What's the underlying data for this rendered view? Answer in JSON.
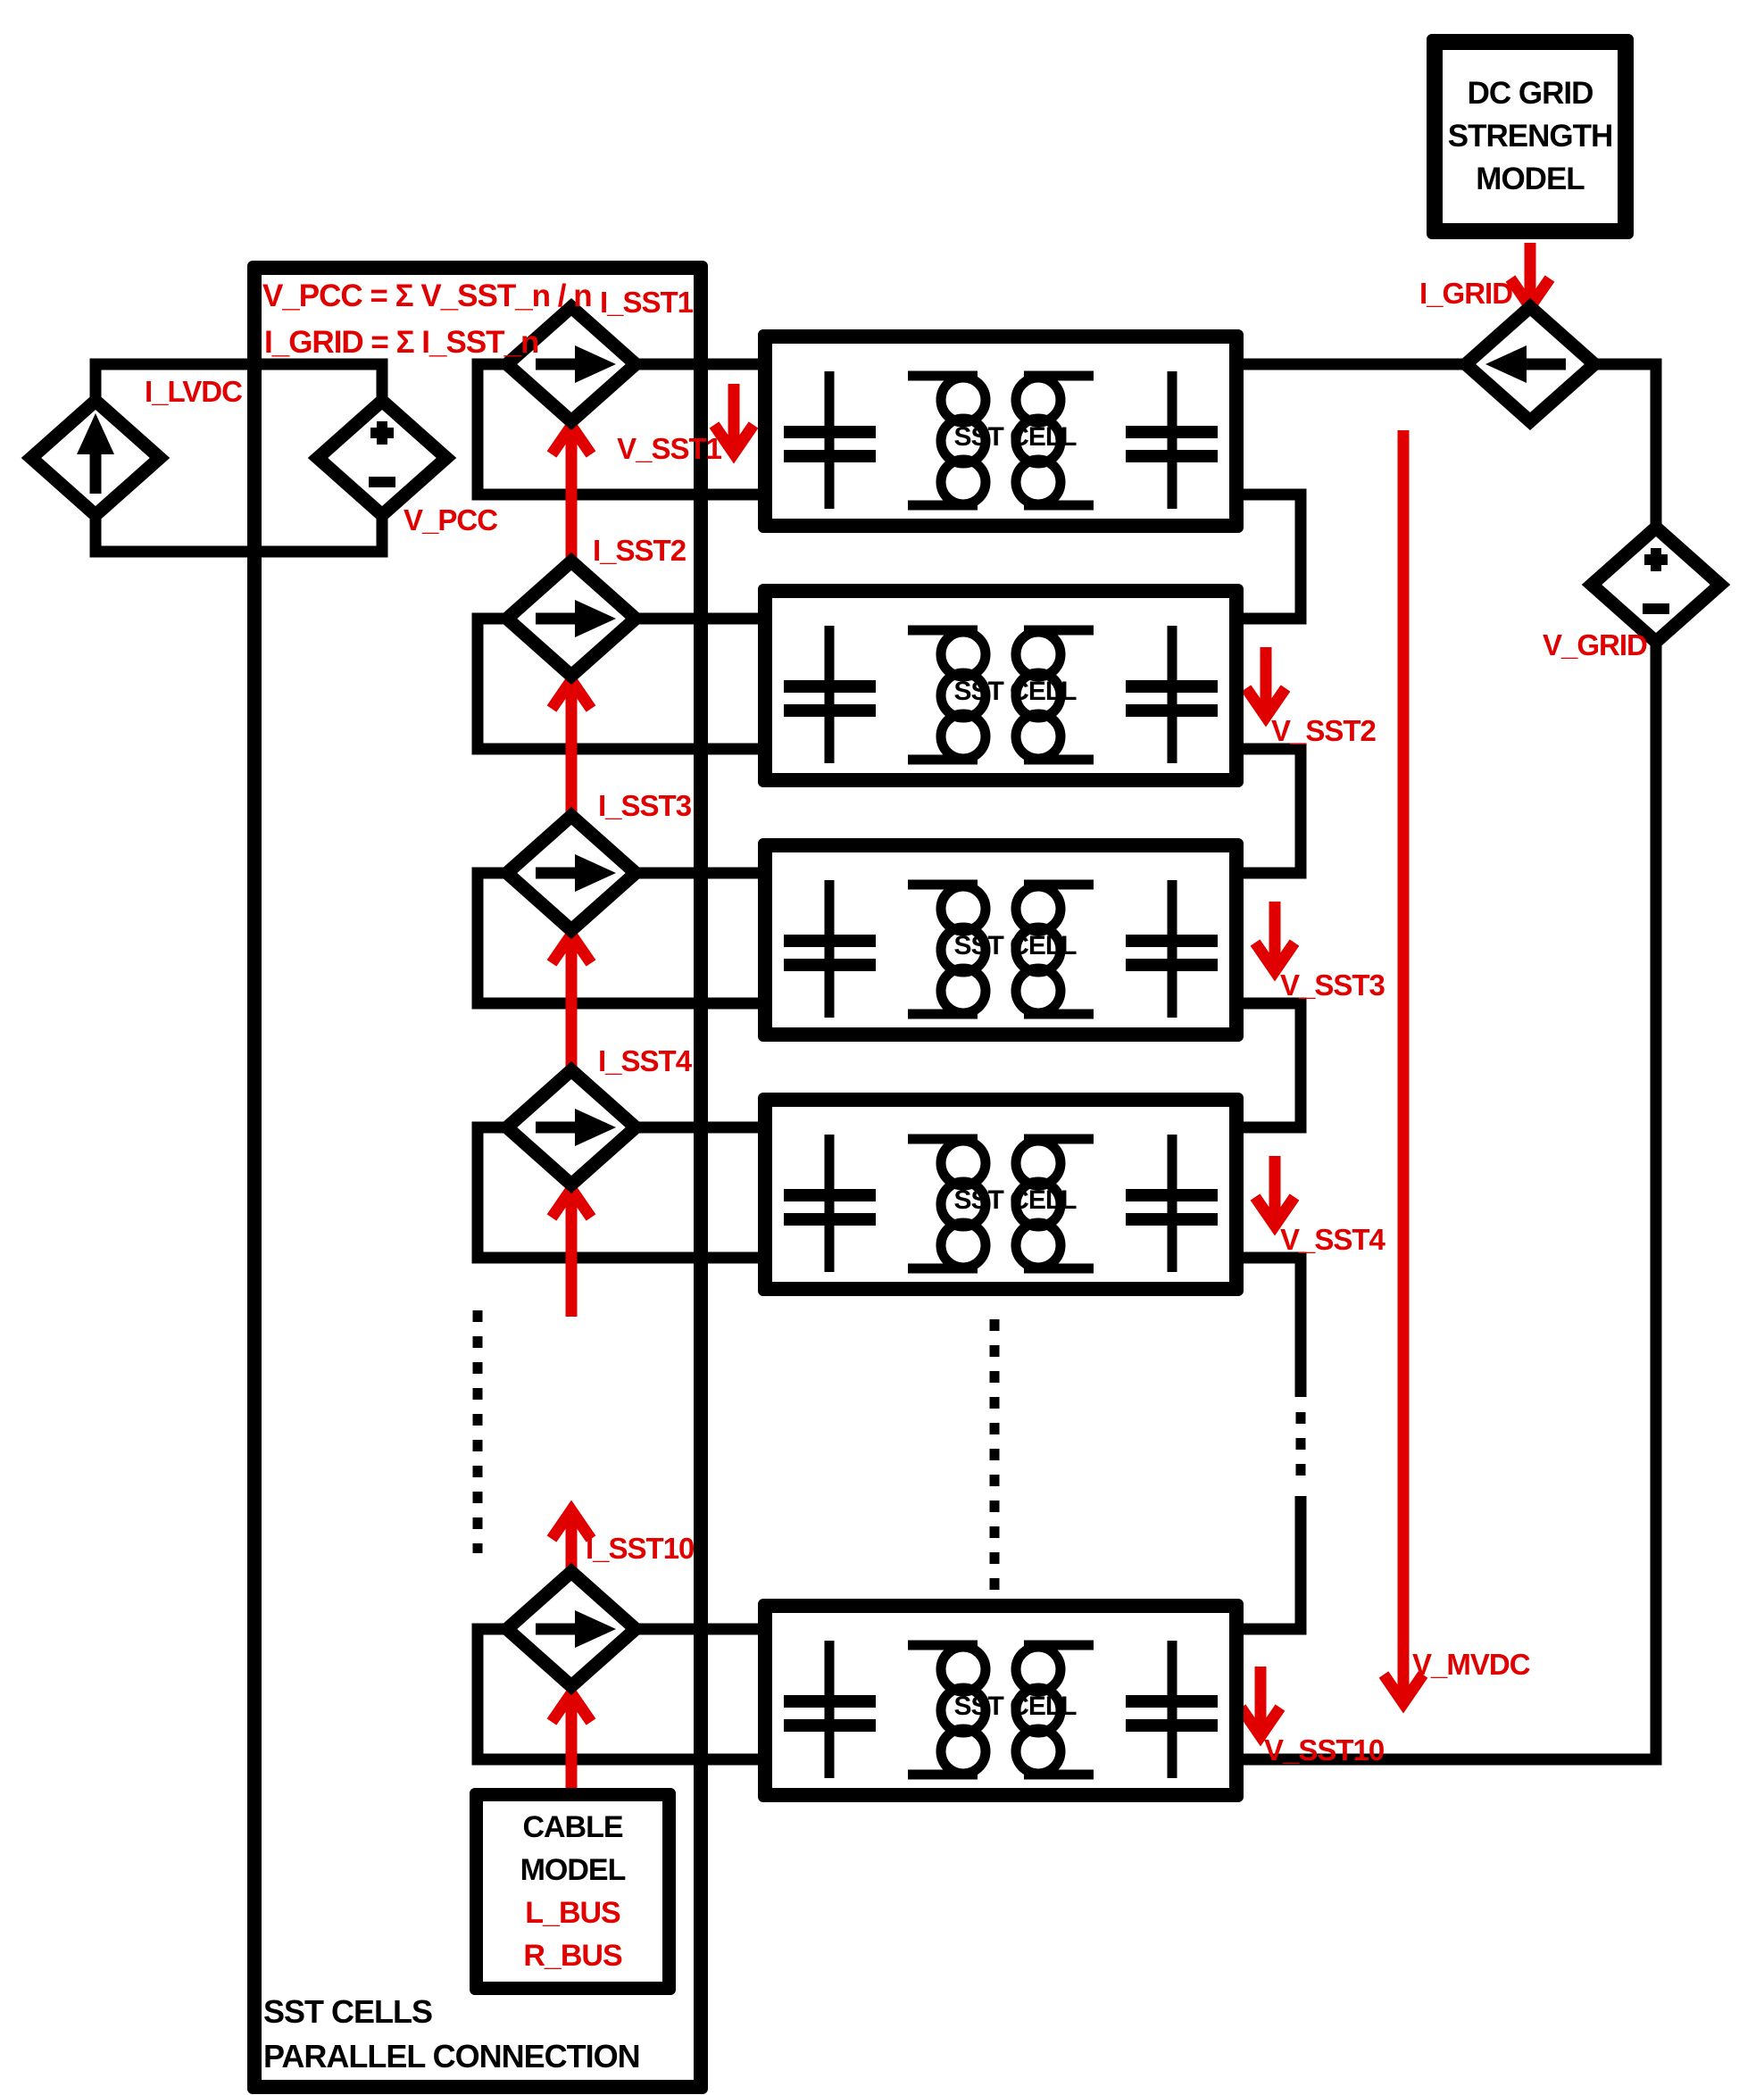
{
  "colors": {
    "red": "#e00000",
    "black": "#000000",
    "background": "#ffffff"
  },
  "outer_box": {
    "label_line1": "SST CELLS",
    "label_line2": "PARALLEL CONNECTION",
    "formula_line1": "V_PCC = Σ V_SST_n / n",
    "formula_line2": "I_GRID = Σ I_SST_n"
  },
  "dc_grid_model": {
    "line1": "DC GRID",
    "line2": "STRENGTH",
    "line3": "MODEL",
    "current_label": "I_GRID"
  },
  "grid_source": {
    "voltage_label": "V_GRID"
  },
  "lvdc_source": {
    "current_label": "I_LVDC",
    "voltage_label": "V_PCC"
  },
  "cable_model": {
    "line1": "CABLE",
    "line2": "MODEL",
    "inductance_label": "L_BUS",
    "resistance_label": "R_BUS"
  },
  "mvdc_bus": {
    "voltage_label": "V_MVDC"
  },
  "cells": [
    {
      "label": "SST CELL",
      "current_label": "I_SST1",
      "voltage_label": "V_SST1"
    },
    {
      "label": "SST CELL",
      "current_label": "I_SST2",
      "voltage_label": "V_SST2"
    },
    {
      "label": "SST CELL",
      "current_label": "I_SST3",
      "voltage_label": "V_SST3"
    },
    {
      "label": "SST CELL",
      "current_label": "I_SST4",
      "voltage_label": "V_SST4"
    },
    {
      "label": "SST CELL",
      "current_label": "I_SST10",
      "voltage_label": "V_SST10"
    }
  ]
}
